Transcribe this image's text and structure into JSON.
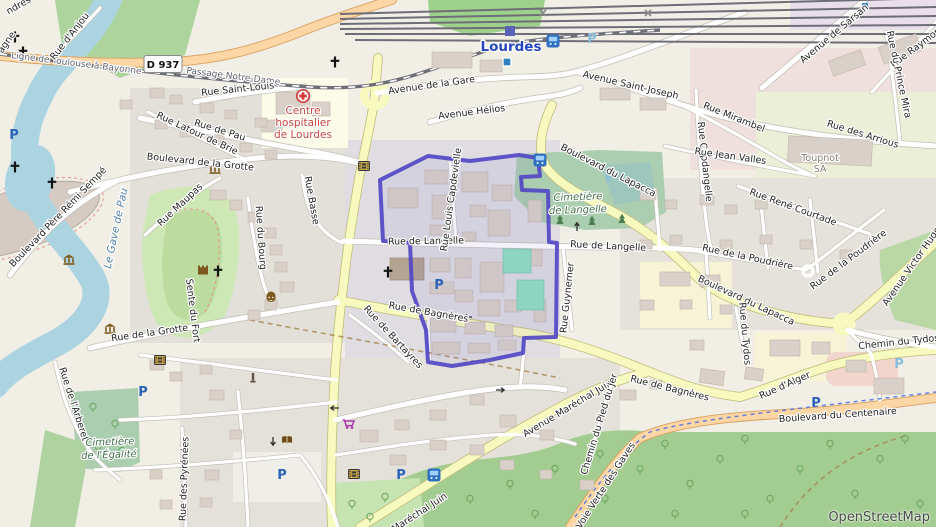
{
  "attribution": {
    "text": "OpenStreetMap"
  },
  "road_shield": {
    "text": "D 937"
  },
  "colors": {
    "boundary": "#5348c4",
    "secondary_road": "#f7fabf",
    "primary_road": "#fcd6a4",
    "water": "#abd4e0",
    "station_label": "#2546be"
  },
  "boundary": {
    "points": "380,180 428,156 470,161 519,155 538,158 540,176 521,177 522,190 548,191 549,242 557,243 556,337 524,338 523,353 490,360 452,366 428,362 426,330 412,291 410,243 383,241"
  },
  "labels": [
    {
      "t": "Lourdes",
      "x": 511,
      "y": 51,
      "r": 0,
      "c": "city"
    },
    {
      "t": "Ligne de Toulouse à Bayonne",
      "x": 76,
      "y": 66,
      "r": 7,
      "c": "rail"
    },
    {
      "t": "Passage Notre-Dame",
      "x": 233,
      "y": 79,
      "r": 7,
      "c": "rail"
    },
    {
      "t": "Rue Saint-Louis",
      "x": 238,
      "y": 92,
      "r": -6
    },
    {
      "t": "Rue d'Anjou",
      "x": 72,
      "y": 38,
      "r": -52
    },
    {
      "t": "ndres",
      "x": 20,
      "y": 8,
      "r": -30
    },
    {
      "t": "agne",
      "x": 9,
      "y": 44,
      "r": -55
    },
    {
      "t": "Rue de Pau",
      "x": 219,
      "y": 133,
      "r": 17
    },
    {
      "t": "Rue Latour de Brie",
      "x": 196,
      "y": 136,
      "r": 25
    },
    {
      "t": "Boulevard de la Grotte",
      "x": 200,
      "y": 165,
      "r": 6
    },
    {
      "t": "Centre",
      "x": 303,
      "y": 114,
      "r": 0,
      "c": "hosp"
    },
    {
      "t": "hospitalier",
      "x": 303,
      "y": 126,
      "r": 0,
      "c": "hosp"
    },
    {
      "t": "de Lourdes",
      "x": 303,
      "y": 138,
      "r": 0,
      "c": "hosp"
    },
    {
      "t": "Avenue de la Gare",
      "x": 432,
      "y": 88,
      "r": -8
    },
    {
      "t": "Avenue Hélios",
      "x": 472,
      "y": 115,
      "r": -7
    },
    {
      "t": "Avenue Saint-Joseph",
      "x": 630,
      "y": 88,
      "r": 13
    },
    {
      "t": "Avenue de Sarsan",
      "x": 836,
      "y": 36,
      "r": -40
    },
    {
      "t": "Rue Raymond",
      "x": 920,
      "y": 48,
      "r": -37
    },
    {
      "t": "Rue du Prince Mira",
      "x": 896,
      "y": 75,
      "r": 78
    },
    {
      "t": "Rue Mirambel",
      "x": 733,
      "y": 120,
      "r": 22
    },
    {
      "t": "Rue des Arrious",
      "x": 862,
      "y": 137,
      "r": 17
    },
    {
      "t": "Rue Capdangelle",
      "x": 702,
      "y": 162,
      "r": 84
    },
    {
      "t": "Rue Jean Valles",
      "x": 730,
      "y": 159,
      "r": 8
    },
    {
      "t": "Toupnot",
      "x": 820,
      "y": 161,
      "r": 0,
      "c": "ind"
    },
    {
      "t": "SA",
      "x": 820,
      "y": 172,
      "r": 0,
      "c": "ind"
    },
    {
      "t": "Rue René Courtade",
      "x": 792,
      "y": 210,
      "r": 20
    },
    {
      "t": "Rue de la Poudrière",
      "x": 747,
      "y": 260,
      "r": 12
    },
    {
      "t": "Rue de la Poudrière",
      "x": 850,
      "y": 262,
      "r": -37
    },
    {
      "t": "Boulevard du Lapacca",
      "x": 607,
      "y": 173,
      "r": 27
    },
    {
      "t": "Boulevard du Lapacca",
      "x": 745,
      "y": 303,
      "r": 25
    },
    {
      "t": "Avenue Victor Hugo",
      "x": 914,
      "y": 268,
      "r": -55
    },
    {
      "t": "Chemin du Tydos",
      "x": 899,
      "y": 345,
      "r": -6
    },
    {
      "t": "Rue du Tydos",
      "x": 742,
      "y": 334,
      "r": 85
    },
    {
      "t": "Rue de Langelle",
      "x": 426,
      "y": 244,
      "r": -1
    },
    {
      "t": "Rue de Langelle",
      "x": 608,
      "y": 249,
      "r": 3
    },
    {
      "t": "Rue Louis Capdevielle",
      "x": 454,
      "y": 200,
      "r": -82
    },
    {
      "t": "Cimetière",
      "x": 578,
      "y": 200,
      "r": -2,
      "c": "cem"
    },
    {
      "t": "de Langelle",
      "x": 578,
      "y": 213,
      "r": -2,
      "c": "cem"
    },
    {
      "t": "Rue Guynemer",
      "x": 570,
      "y": 298,
      "r": -84
    },
    {
      "t": "Rue de Bagnères",
      "x": 428,
      "y": 315,
      "r": 10
    },
    {
      "t": "Rue de Bagnères",
      "x": 669,
      "y": 391,
      "r": 14
    },
    {
      "t": "Rue d'Alger",
      "x": 786,
      "y": 388,
      "r": -24
    },
    {
      "t": "Boulevard du Centenaire",
      "x": 838,
      "y": 418,
      "r": -4
    },
    {
      "t": "Avenue Maréchal Juin",
      "x": 569,
      "y": 411,
      "r": -31
    },
    {
      "t": "Maréchal Juin",
      "x": 421,
      "y": 515,
      "r": -33
    },
    {
      "t": "Rue de Bartayres",
      "x": 391,
      "y": 339,
      "r": 47
    },
    {
      "t": "Chemin du Pied du Jer",
      "x": 602,
      "y": 425,
      "r": -73
    },
    {
      "t": "Voie Verte des Gaves",
      "x": 608,
      "y": 487,
      "r": -57
    },
    {
      "t": "Boulevard Père Rémi Sempé",
      "x": 60,
      "y": 219,
      "r": -46
    },
    {
      "t": "Rue Maupas",
      "x": 182,
      "y": 207,
      "r": -43
    },
    {
      "t": "Le Gave de Pau",
      "x": 119,
      "y": 229,
      "r": -78,
      "c": "water"
    },
    {
      "t": "Rue du Bourg",
      "x": 258,
      "y": 238,
      "r": 86
    },
    {
      "t": "Rue Basse",
      "x": 309,
      "y": 201,
      "r": 80
    },
    {
      "t": "Sente du Fort",
      "x": 190,
      "y": 311,
      "r": 83
    },
    {
      "t": "Rue de l'Arberet",
      "x": 71,
      "y": 405,
      "r": 72
    },
    {
      "t": "Rue des Pyrénées",
      "x": 187,
      "y": 479,
      "r": -88
    },
    {
      "t": "Cimetière",
      "x": 110,
      "y": 445,
      "r": -2,
      "c": "cem"
    },
    {
      "t": "de l'Égalité",
      "x": 109,
      "y": 458,
      "r": -2,
      "c": "cem"
    },
    {
      "t": "Rue de la Grotte",
      "x": 150,
      "y": 336,
      "r": -8
    }
  ],
  "icons": [
    {
      "s": "parking",
      "x": 14,
      "y": 134
    },
    {
      "s": "parking",
      "x": 143,
      "y": 391
    },
    {
      "s": "parking",
      "x": 282,
      "y": 474
    },
    {
      "s": "parking",
      "x": 401,
      "y": 474
    },
    {
      "s": "parking",
      "x": 439,
      "y": 284
    },
    {
      "s": "parking",
      "x": 816,
      "y": 402
    },
    {
      "s": "parking",
      "x": 592,
      "y": 38,
      "c": "light"
    },
    {
      "s": "parking",
      "x": 610,
      "y": 176,
      "c": "light"
    },
    {
      "s": "parking",
      "x": 899,
      "y": 363,
      "c": "light"
    },
    {
      "s": "bus-stop",
      "x": 553,
      "y": 41
    },
    {
      "s": "bus-stop",
      "x": 540,
      "y": 160
    },
    {
      "s": "bus-stop",
      "x": 434,
      "y": 475
    },
    {
      "s": "train-station",
      "x": 510,
      "y": 31
    },
    {
      "s": "tram-halt",
      "x": 507,
      "y": 62
    },
    {
      "s": "transit-stop",
      "x": 865,
      "y": 6
    },
    {
      "s": "church-cross",
      "x": 15,
      "y": 37
    },
    {
      "s": "church-cross",
      "x": 23,
      "y": 52
    },
    {
      "s": "church-cross",
      "x": 335,
      "y": 62
    },
    {
      "s": "church-cross",
      "x": 52,
      "y": 183
    },
    {
      "s": "church-cross",
      "x": 15,
      "y": 167
    },
    {
      "s": "church-cross",
      "x": 218,
      "y": 271
    },
    {
      "s": "church-cross",
      "x": 388,
      "y": 272
    },
    {
      "s": "hospital",
      "x": 303,
      "y": 96
    },
    {
      "s": "museum",
      "x": 215,
      "y": 169
    },
    {
      "s": "museum",
      "x": 69,
      "y": 260
    },
    {
      "s": "museum",
      "x": 110,
      "y": 329
    },
    {
      "s": "theatre",
      "x": 271,
      "y": 299
    },
    {
      "s": "castle",
      "x": 203,
      "y": 270
    },
    {
      "s": "cinema",
      "x": 364,
      "y": 166
    },
    {
      "s": "cinema",
      "x": 354,
      "y": 474
    },
    {
      "s": "cinema",
      "x": 160,
      "y": 360
    },
    {
      "s": "library",
      "x": 287,
      "y": 440
    },
    {
      "s": "memorial",
      "x": 253,
      "y": 378
    },
    {
      "s": "supermarket",
      "x": 348,
      "y": 424
    },
    {
      "s": "level-crossing",
      "x": 543,
      "y": 13
    },
    {
      "s": "level-crossing",
      "x": 648,
      "y": 13
    },
    {
      "s": "oneway-arrow",
      "x": 468,
      "y": 317,
      "r": 0
    },
    {
      "s": "oneway-arrow",
      "x": 500,
      "y": 390,
      "r": 180
    },
    {
      "s": "oneway-arrow",
      "x": 577,
      "y": 227,
      "r": 90
    },
    {
      "s": "oneway-arrow",
      "x": 273,
      "y": 441,
      "r": -90
    },
    {
      "s": "oneway-arrow",
      "x": 335,
      "y": 408,
      "r": 0
    },
    {
      "s": "conifer-tree",
      "x": 560,
      "y": 220
    },
    {
      "s": "conifer-tree",
      "x": 592,
      "y": 221
    },
    {
      "s": "conifer-tree",
      "x": 622,
      "y": 219
    },
    {
      "s": "tree",
      "x": 470,
      "y": 500
    },
    {
      "s": "tree",
      "x": 510,
      "y": 485
    },
    {
      "s": "tree",
      "x": 555,
      "y": 470
    },
    {
      "s": "tree",
      "x": 600,
      "y": 455
    },
    {
      "s": "tree",
      "x": 640,
      "y": 470
    },
    {
      "s": "tree",
      "x": 665,
      "y": 445
    },
    {
      "s": "tree",
      "x": 690,
      "y": 485
    },
    {
      "s": "tree",
      "x": 720,
      "y": 460
    },
    {
      "s": "tree",
      "x": 745,
      "y": 440
    },
    {
      "s": "tree",
      "x": 770,
      "y": 500
    },
    {
      "s": "tree",
      "x": 800,
      "y": 470
    },
    {
      "s": "tree",
      "x": 830,
      "y": 445
    },
    {
      "s": "tree",
      "x": 855,
      "y": 495
    },
    {
      "s": "tree",
      "x": 880,
      "y": 460
    },
    {
      "s": "tree",
      "x": 905,
      "y": 440
    },
    {
      "s": "tree",
      "x": 920,
      "y": 505
    },
    {
      "s": "tree",
      "x": 745,
      "y": 515
    },
    {
      "s": "tree",
      "x": 675,
      "y": 515
    },
    {
      "s": "tree",
      "x": 605,
      "y": 500
    },
    {
      "s": "tree",
      "x": 535,
      "y": 515
    },
    {
      "s": "tree",
      "x": 93,
      "y": 408
    },
    {
      "s": "tree",
      "x": 115,
      "y": 425
    },
    {
      "s": "tree",
      "x": 98,
      "y": 448
    },
    {
      "s": "tree",
      "x": 122,
      "y": 452
    },
    {
      "s": "tree",
      "x": 352,
      "y": 505
    },
    {
      "s": "tree",
      "x": 385,
      "y": 498
    },
    {
      "s": "tree",
      "x": 370,
      "y": 518
    }
  ]
}
